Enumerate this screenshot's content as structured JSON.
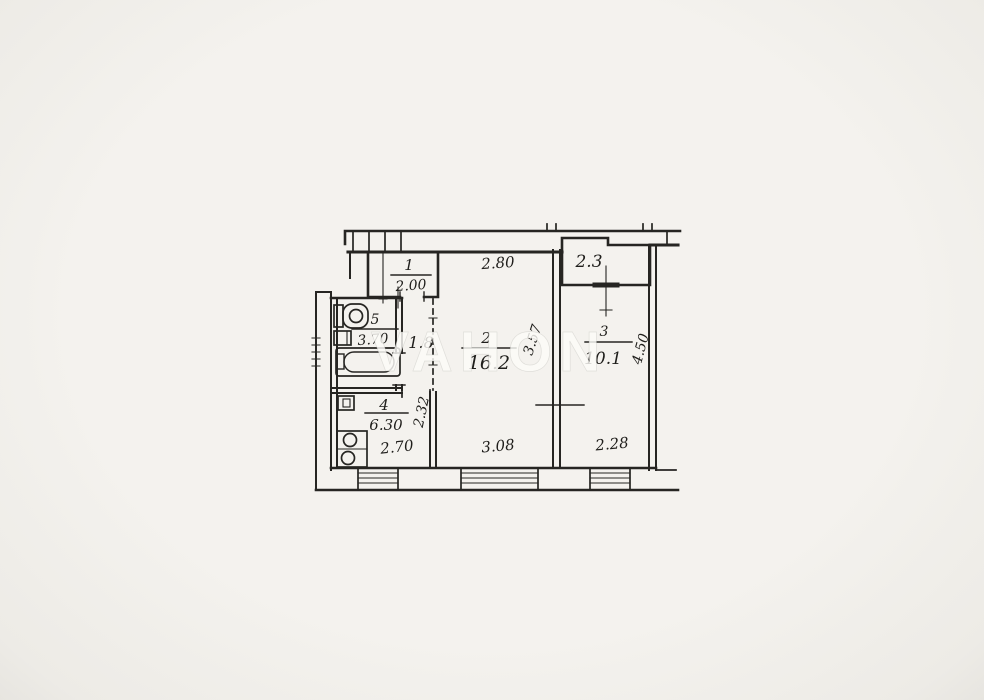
{
  "watermark": "VAHON",
  "colors": {
    "paper": "#f2f0eb",
    "ink": "#262522"
  },
  "dimensions": {
    "top_width": "2.80"
  },
  "rooms": {
    "hall": {
      "number": "1",
      "value": "2.00"
    },
    "bathroom": {
      "number": "5",
      "value": "3.70"
    },
    "corridor": {
      "value": "1.8"
    },
    "living_room": {
      "number": "2",
      "value": "16.2",
      "width": "3.08",
      "depth": "3.57"
    },
    "bedroom": {
      "number": "3",
      "value": "10.1",
      "width": "2.28",
      "depth": "4.50"
    },
    "kitchen": {
      "number": "4",
      "value": "6.30",
      "width": "2.70",
      "depth": "2.32"
    },
    "balcony": {
      "value": "2.3"
    }
  }
}
